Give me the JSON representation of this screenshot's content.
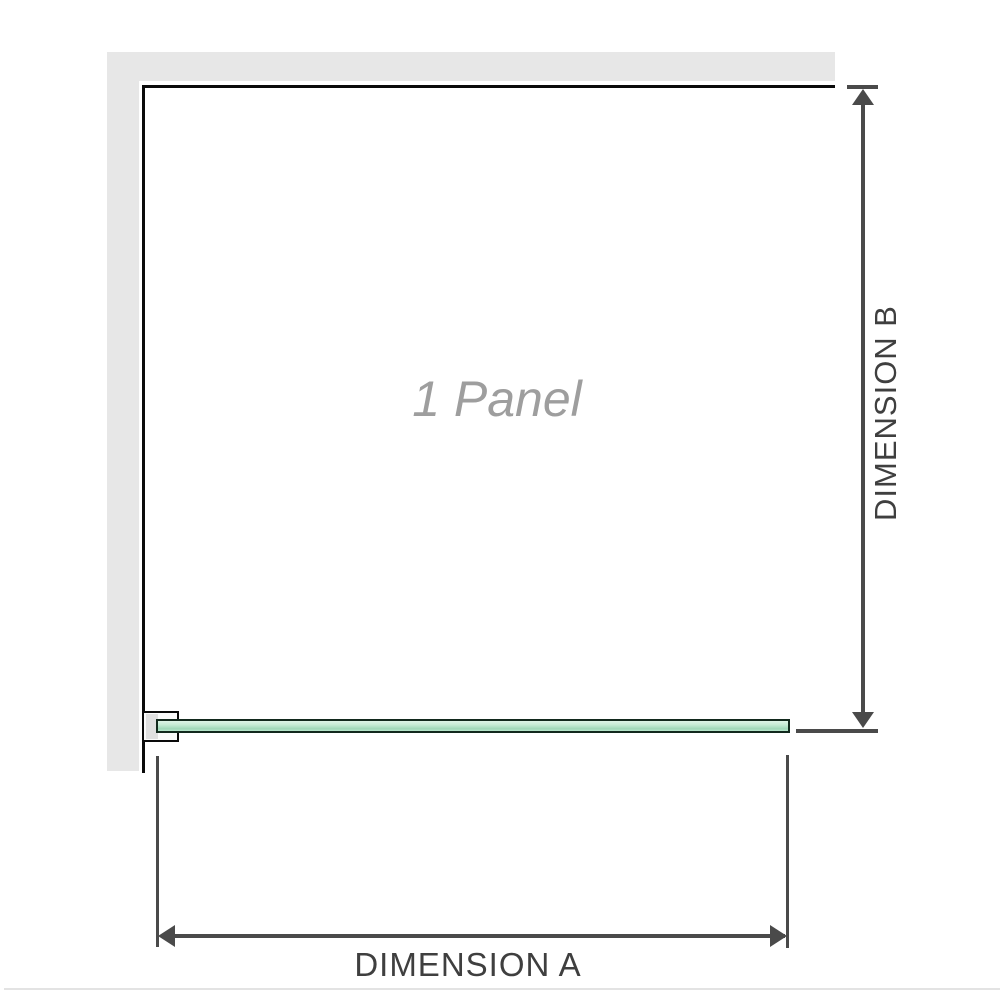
{
  "diagram": {
    "panel_label": "1 Panel",
    "dimension_a_label": "DIMENSION A",
    "dimension_b_label": "DIMENSION B"
  },
  "colors": {
    "wall_fill": "#e7e7e7",
    "outline": "#0a0a0a",
    "dimension_line": "#4a4a4a",
    "label_text": "#3f3f3f",
    "panel_text": "#9e9e9e",
    "glass_edge": "#12291d"
  }
}
